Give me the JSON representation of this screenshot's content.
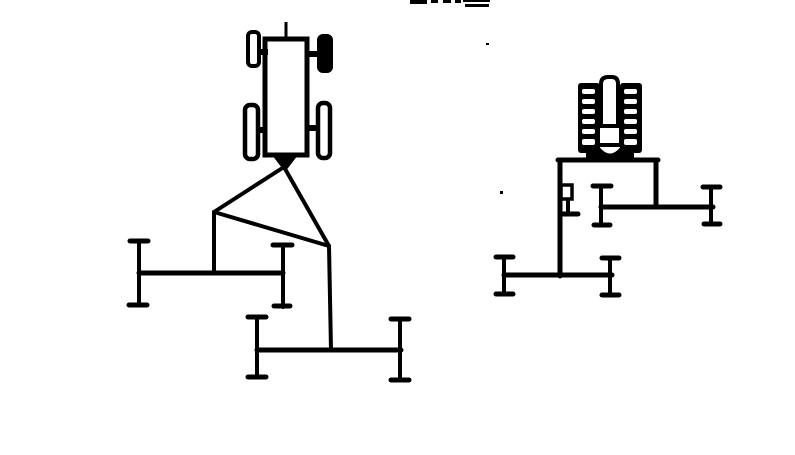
{
  "canvas": {
    "width": 795,
    "height": 455,
    "background_color": "#ffffff",
    "ink_color": "#000000"
  },
  "document": {
    "kind": "technical line drawing",
    "visible_text": "",
    "note_marks": {
      "top_edge_cropped_text_marks": "partial glyph fragments cut off at top edge",
      "stray_dot_upper": "small ink dot near top center",
      "stray_dot_middle": "small ink dot left of rear-view frame"
    }
  },
  "figures": [
    {
      "id": "plan_view",
      "name": "tractor-plan-view-with-offset-gang-implements",
      "parts": [
        "tractor-body",
        "dash-dot-centerline",
        "front-left-wheel",
        "front-right-wheel",
        "rear-left-wheel",
        "rear-right-wheel",
        "hitch-point-triangle",
        "drawbar-triangle-linkage",
        "front-gang-toolbar",
        "rear-gang-toolbar"
      ]
    },
    {
      "id": "rear_view",
      "name": "tractor-rear-view-with-offset-gang-implements",
      "parts": [
        "left-treaded-tire",
        "right-treaded-tire",
        "tractor-body",
        "hitch-dome",
        "mounting-frame",
        "frame-bracket",
        "upper-gang-toolbar",
        "lower-gang-toolbar"
      ]
    }
  ]
}
